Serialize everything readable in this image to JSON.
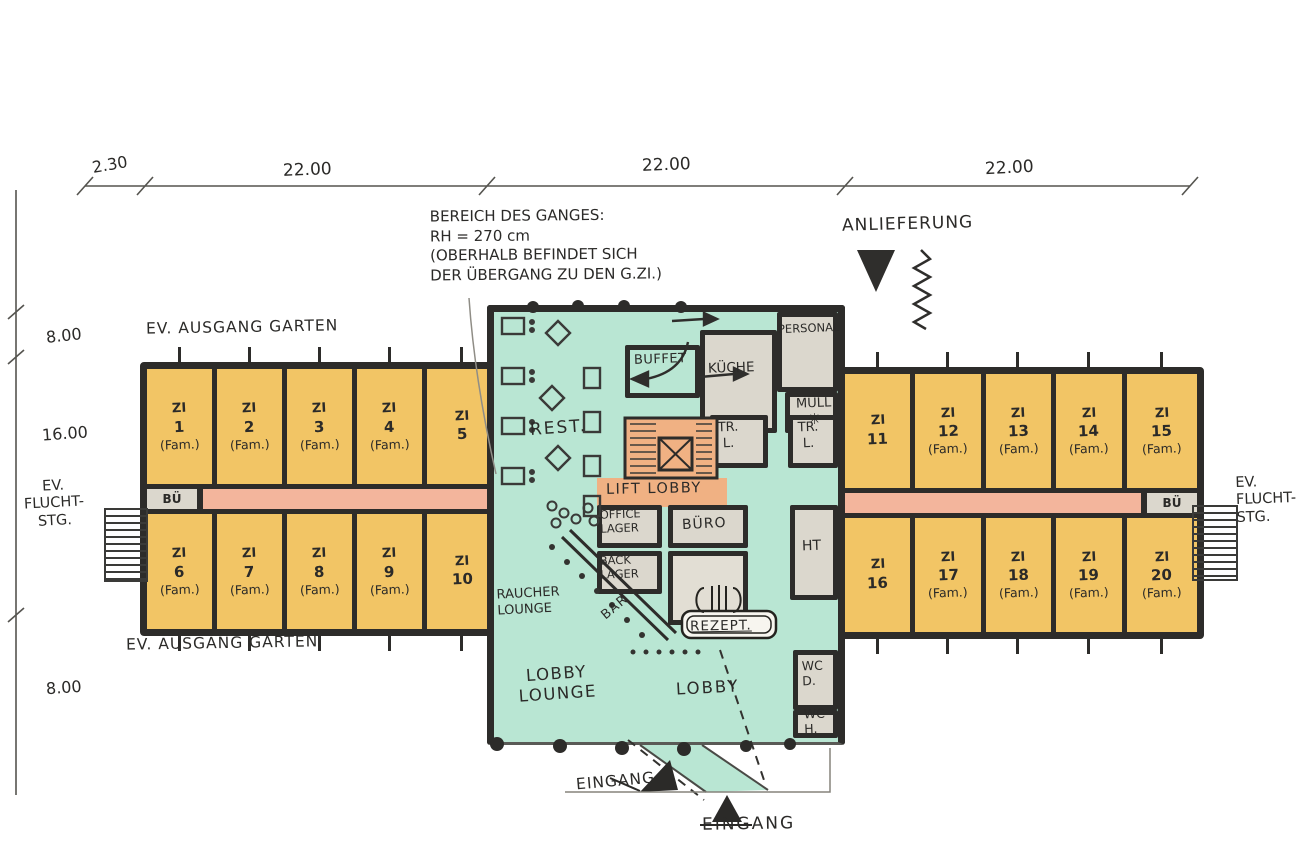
{
  "title": "Hand-drawn hotel ground floor plan sketch",
  "dimensions": {
    "top": [
      "2.30",
      "22.00",
      "22.00",
      "22.00"
    ],
    "left": [
      "8.00",
      "16.00",
      "8.00"
    ]
  },
  "notes": {
    "corridor_note": "BEREICH DES GANGES:\nRH = 270 cm\n(OBERHALB BEFINDET SICH\nDER ÜBERGANG ZU DEN G.ZI.)",
    "delivery": "ANLIEFERUNG",
    "garden_exit_top": "EV. AUSGANG GARTEN",
    "garden_exit_bottom": "EV. AUSGANG GARTEN",
    "escape_left": "EV.\nFLUCHT-\nSTG.",
    "escape_right": "EV.\nFLUCHT-\nSTG.",
    "entrance_west": "EINGANG",
    "entrance_main": "EINGANG"
  },
  "rooms": {
    "left_top": [
      {
        "zi": "ZI",
        "num": "1",
        "fam": "(Fam.)"
      },
      {
        "zi": "ZI",
        "num": "2",
        "fam": "(Fam.)"
      },
      {
        "zi": "ZI",
        "num": "3",
        "fam": "(Fam.)"
      },
      {
        "zi": "ZI",
        "num": "4",
        "fam": "(Fam.)"
      },
      {
        "zi": "ZI",
        "num": "5",
        "fam": ""
      }
    ],
    "left_bottom": [
      {
        "zi": "ZI",
        "num": "6",
        "fam": "(Fam.)"
      },
      {
        "zi": "ZI",
        "num": "7",
        "fam": "(Fam.)"
      },
      {
        "zi": "ZI",
        "num": "8",
        "fam": "(Fam.)"
      },
      {
        "zi": "ZI",
        "num": "9",
        "fam": "(Fam.)"
      },
      {
        "zi": "ZI",
        "num": "10",
        "fam": ""
      }
    ],
    "right_top": [
      {
        "zi": "ZI",
        "num": "11",
        "fam": ""
      },
      {
        "zi": "ZI",
        "num": "12",
        "fam": "(Fam.)"
      },
      {
        "zi": "ZI",
        "num": "13",
        "fam": "(Fam.)"
      },
      {
        "zi": "ZI",
        "num": "14",
        "fam": "(Fam.)"
      },
      {
        "zi": "ZI",
        "num": "15",
        "fam": "(Fam.)"
      }
    ],
    "right_bottom": [
      {
        "zi": "ZI",
        "num": "16",
        "fam": ""
      },
      {
        "zi": "ZI",
        "num": "17",
        "fam": "(Fam.)"
      },
      {
        "zi": "ZI",
        "num": "18",
        "fam": "(Fam.)"
      },
      {
        "zi": "ZI",
        "num": "19",
        "fam": "(Fam.)"
      },
      {
        "zi": "ZI",
        "num": "20",
        "fam": "(Fam.)"
      }
    ]
  },
  "core": {
    "rest": "REST.",
    "buffet": "BUFFET",
    "kueche": "KÜCHE",
    "personal": "PERSONAL",
    "muell": "MÜLL",
    "muell_symbol": "✳",
    "tr_left": "TR.\nL.",
    "tr_right": "TR.\nL.",
    "lift_lobby": "LIFT LOBBY",
    "office_lager": "OFFICE\nLAGER",
    "buero": "BÜRO",
    "back_lager": "BACK\nLAGER",
    "bar": "BAR",
    "rezeption": "REZEPT.",
    "ht": "HT",
    "wc_d": "WC\nD.",
    "wc_h": "WC\nH.",
    "raucher_lounge": "RAUCHER\nLOUNGE",
    "lobby_lounge": "LOBBY\nLOUNGE",
    "lobby": "LOBBY",
    "bue_left": "BÜ",
    "bue_right": "BÜ"
  },
  "colors": {
    "room_yellow": "#f2c565",
    "corridor_pink": "#f3b59c",
    "lobby_green": "#b9e6d3",
    "service_grey": "#dbd7cd",
    "stair_orange": "#f0b183",
    "wall": "#2d2c2a"
  }
}
